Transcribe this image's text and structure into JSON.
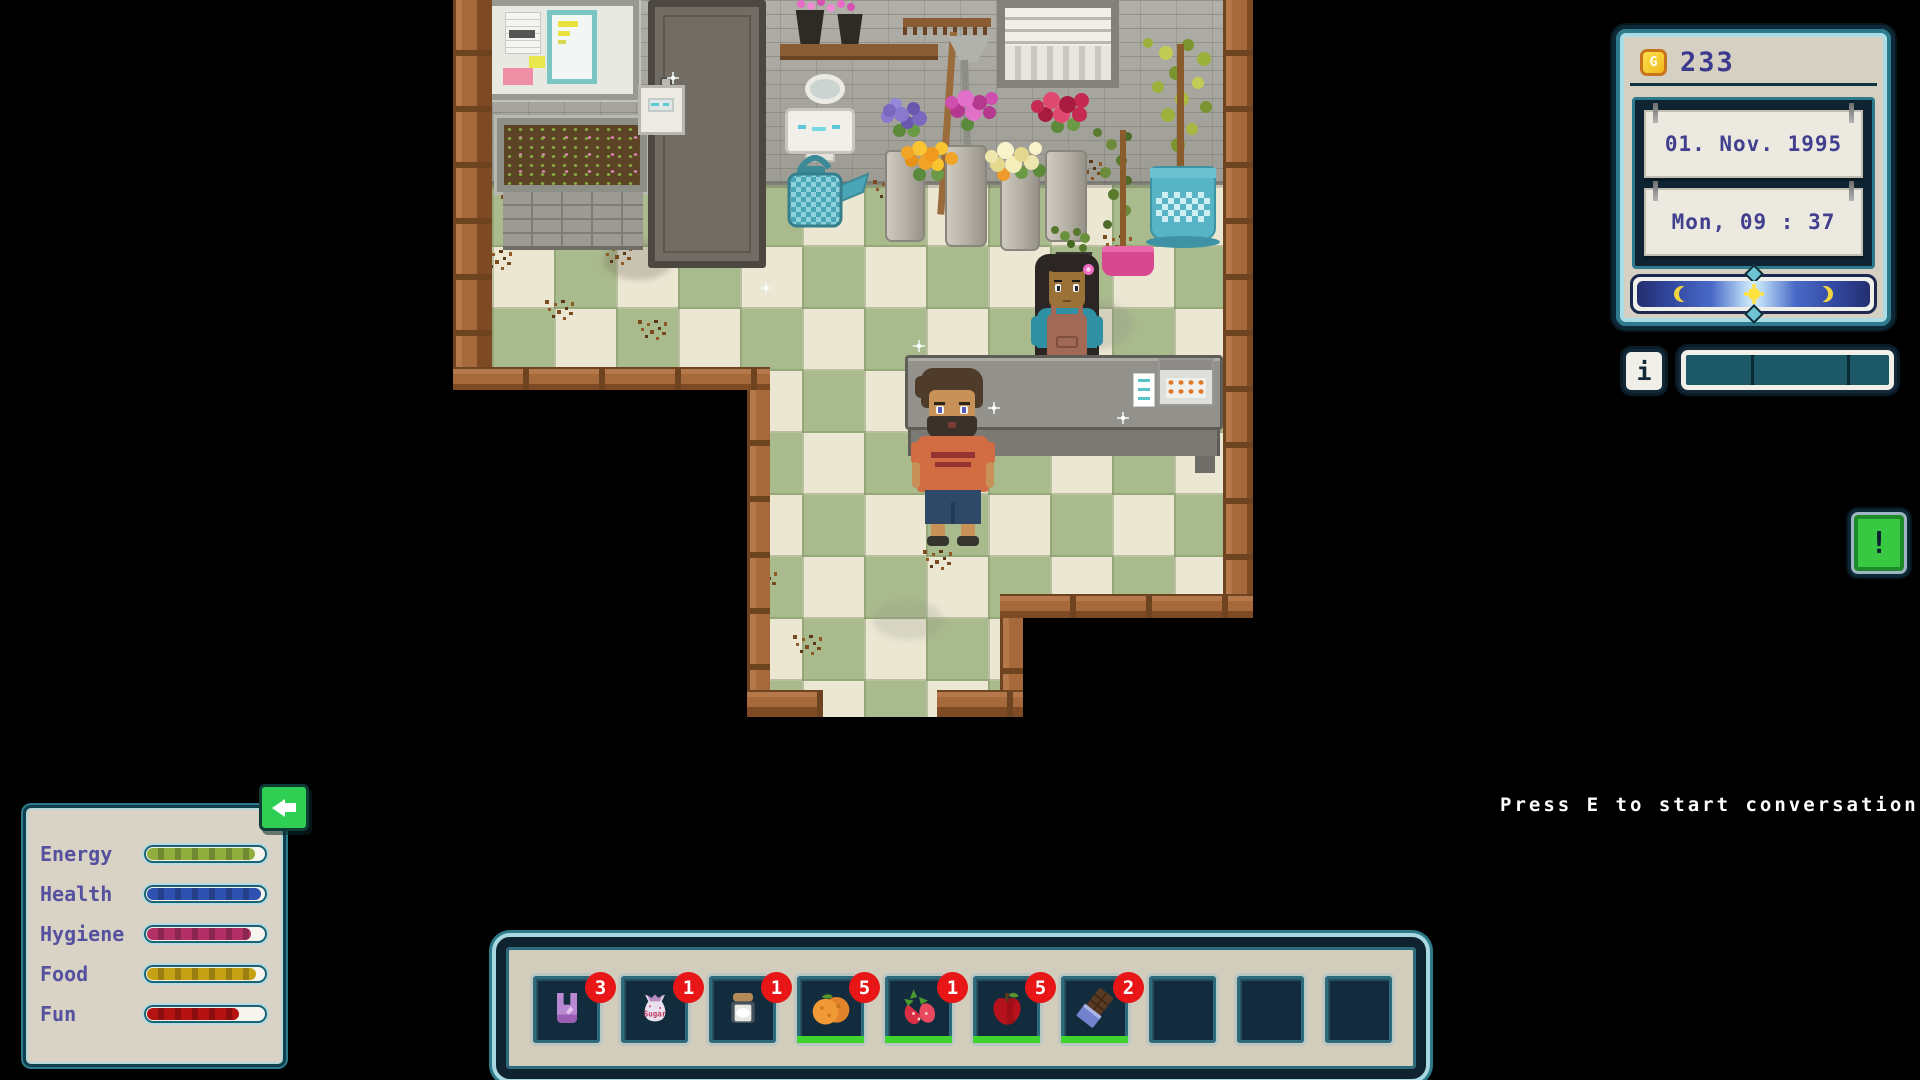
{
  "hud": {
    "money": {
      "amount": "233",
      "coin_letter": "G"
    },
    "clock": {
      "date": "01. Nov. 1995",
      "daytime": "Mon, 09 : 37"
    },
    "info_label": "i",
    "alert_label": "!",
    "prompt": "Press E to start conversation",
    "colors": {
      "badge": "#e81616",
      "fresh": "#3fd32f",
      "hud_accent": "#2d7a8c",
      "text_purple": "#413f8e"
    },
    "stats": {
      "rows": [
        {
          "label": "Energy",
          "value": 91,
          "color": "#8fae3e"
        },
        {
          "label": "Health",
          "value": 96,
          "color": "#2f52b0"
        },
        {
          "label": "Hygiene",
          "value": 87,
          "color": "#b23066"
        },
        {
          "label": "Food",
          "value": 92,
          "color": "#c5a214"
        },
        {
          "label": "Fun",
          "value": 77,
          "color": "#b51212"
        }
      ]
    },
    "hotbar": {
      "sugar_label": "Sugar",
      "slots": [
        {
          "item": "shopping-bag",
          "count": 3,
          "fresh": false
        },
        {
          "item": "sugar-bag",
          "count": 1,
          "fresh": false
        },
        {
          "item": "jar",
          "count": 1,
          "fresh": false
        },
        {
          "item": "oranges",
          "count": 5,
          "fresh": true
        },
        {
          "item": "strawberries",
          "count": 1,
          "fresh": true
        },
        {
          "item": "apple",
          "count": 5,
          "fresh": true
        },
        {
          "item": "chocolate",
          "count": 2,
          "fresh": true
        },
        {
          "item": null,
          "count": null,
          "fresh": false
        },
        {
          "item": null,
          "count": null,
          "fresh": false
        },
        {
          "item": null,
          "count": null,
          "fresh": false
        }
      ]
    }
  }
}
